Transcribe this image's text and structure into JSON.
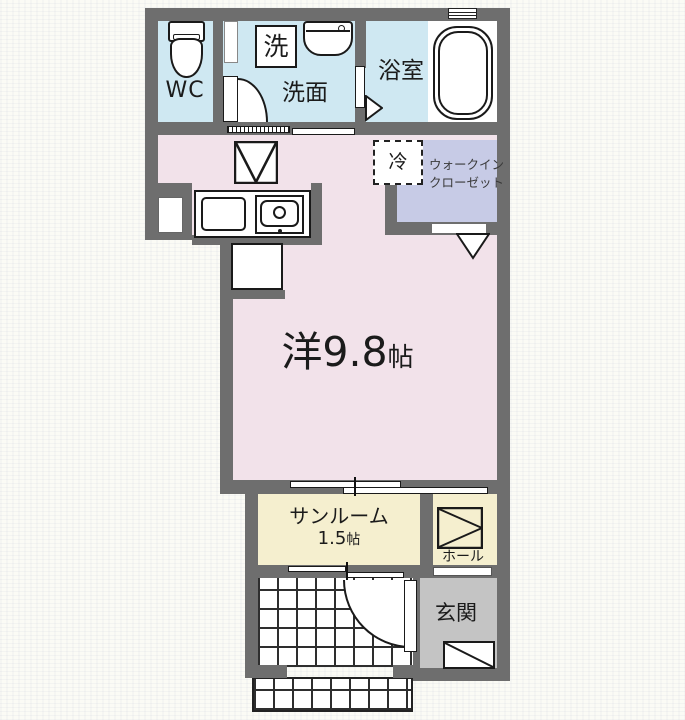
{
  "colors": {
    "wall": "#6e6e6e",
    "water_rooms": "#cfe8f2",
    "main_room": "#f2e2ea",
    "closet": "#c7cbe6",
    "sunroom_hall": "#f5efcf",
    "entrance": "#c4c4c4",
    "background": "#fbfbf5",
    "line": "#1a1a1a"
  },
  "rooms": {
    "wc": {
      "label": "WC"
    },
    "washer_box": {
      "label": "洗"
    },
    "washroom": {
      "label": "洗面"
    },
    "bathroom": {
      "label": "浴室"
    },
    "refrigerator": {
      "label": "冷"
    },
    "walk_in_closet": {
      "line1": "ウォークイン",
      "line2": "クローゼット"
    },
    "western_room": {
      "name": "洋9.8",
      "unit": "帖"
    },
    "sunroom": {
      "label": "サンルーム",
      "size": "1.5",
      "size_unit": "帖"
    },
    "hall": {
      "label": "ホール"
    },
    "entrance": {
      "label": "玄関"
    }
  }
}
